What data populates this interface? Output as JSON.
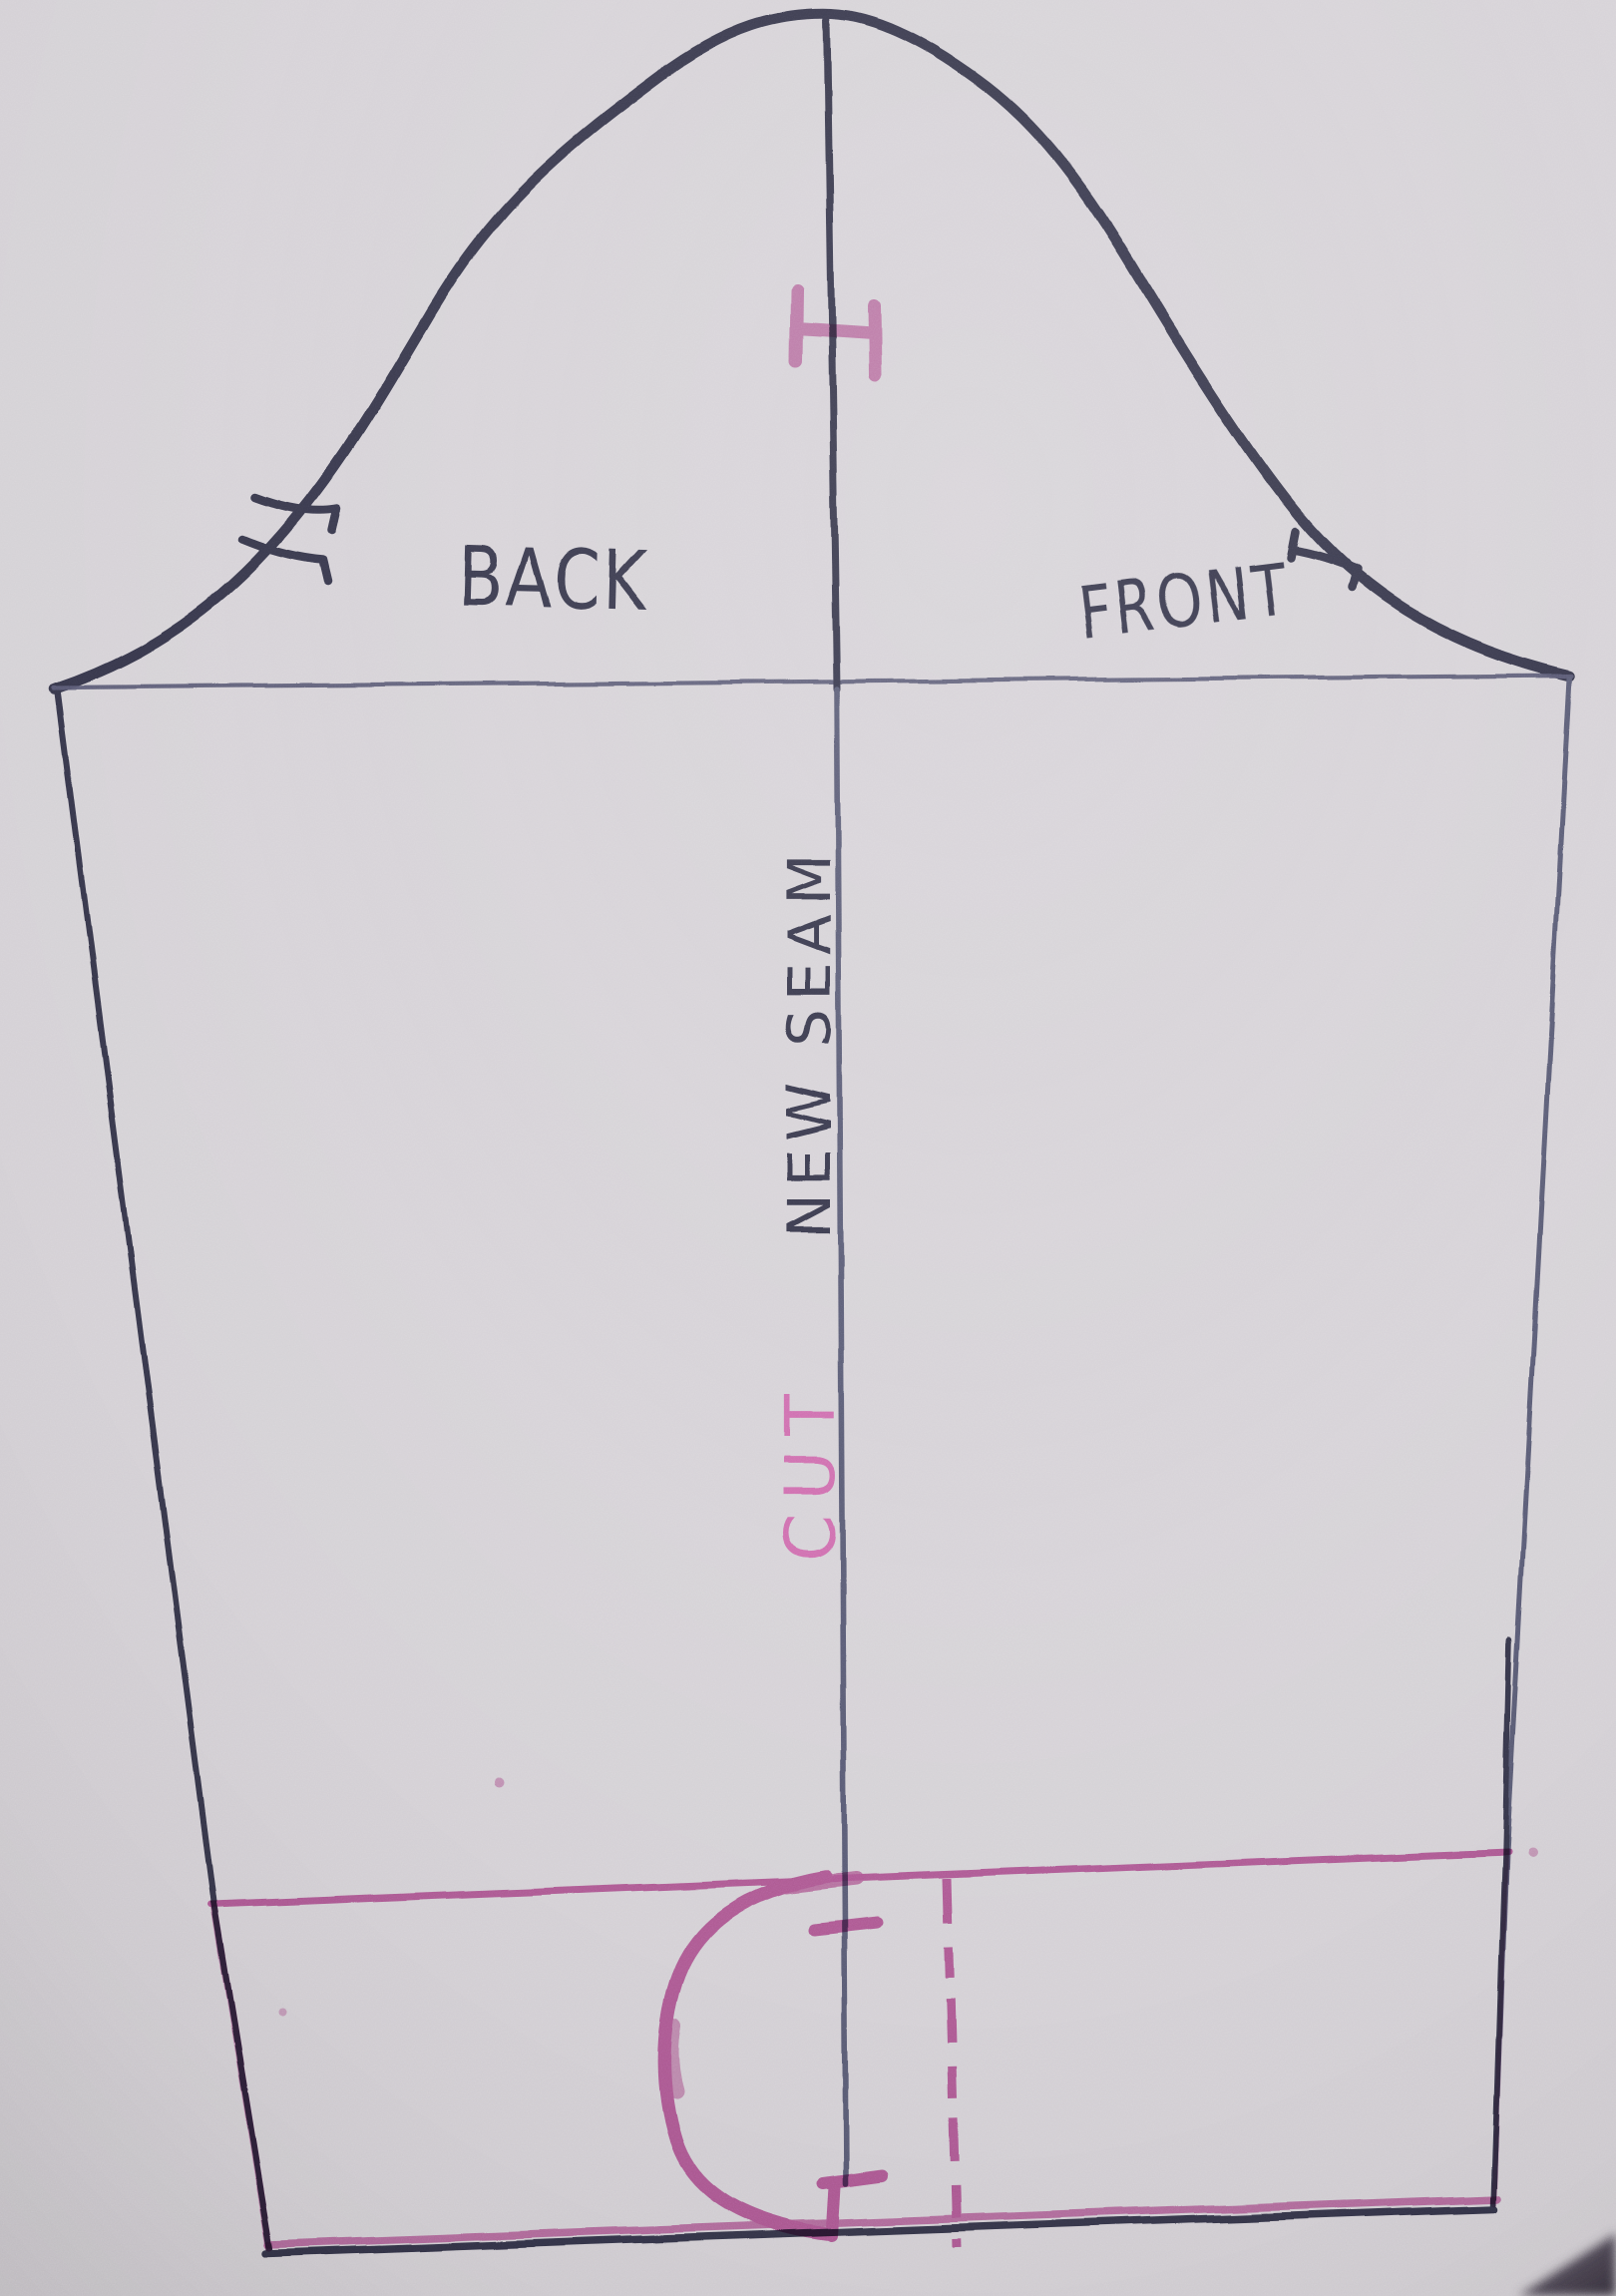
{
  "photo": {
    "subject": "hand-drawn sleeve sewing pattern on paper"
  },
  "labels": {
    "back": "BACK",
    "front": "FRONT",
    "new_seam": "NEW SEAM",
    "cut": "CUT"
  },
  "colors": {
    "paper": "#d6d2d7",
    "ink": "#343549",
    "ink_light": "#585a73",
    "pink": "#cf6cae",
    "pink_soft": "#dd8ec3",
    "shadow": "#47404a"
  },
  "marks": {
    "cap_top_match": "I-beam match mark",
    "back_notch": "double notch ticks",
    "front_notch": "single notch tick",
    "center_tick": "match tick on cut line",
    "hem_tack": "T-shaped tack mark",
    "fold_line": "pink dashed fold line"
  }
}
